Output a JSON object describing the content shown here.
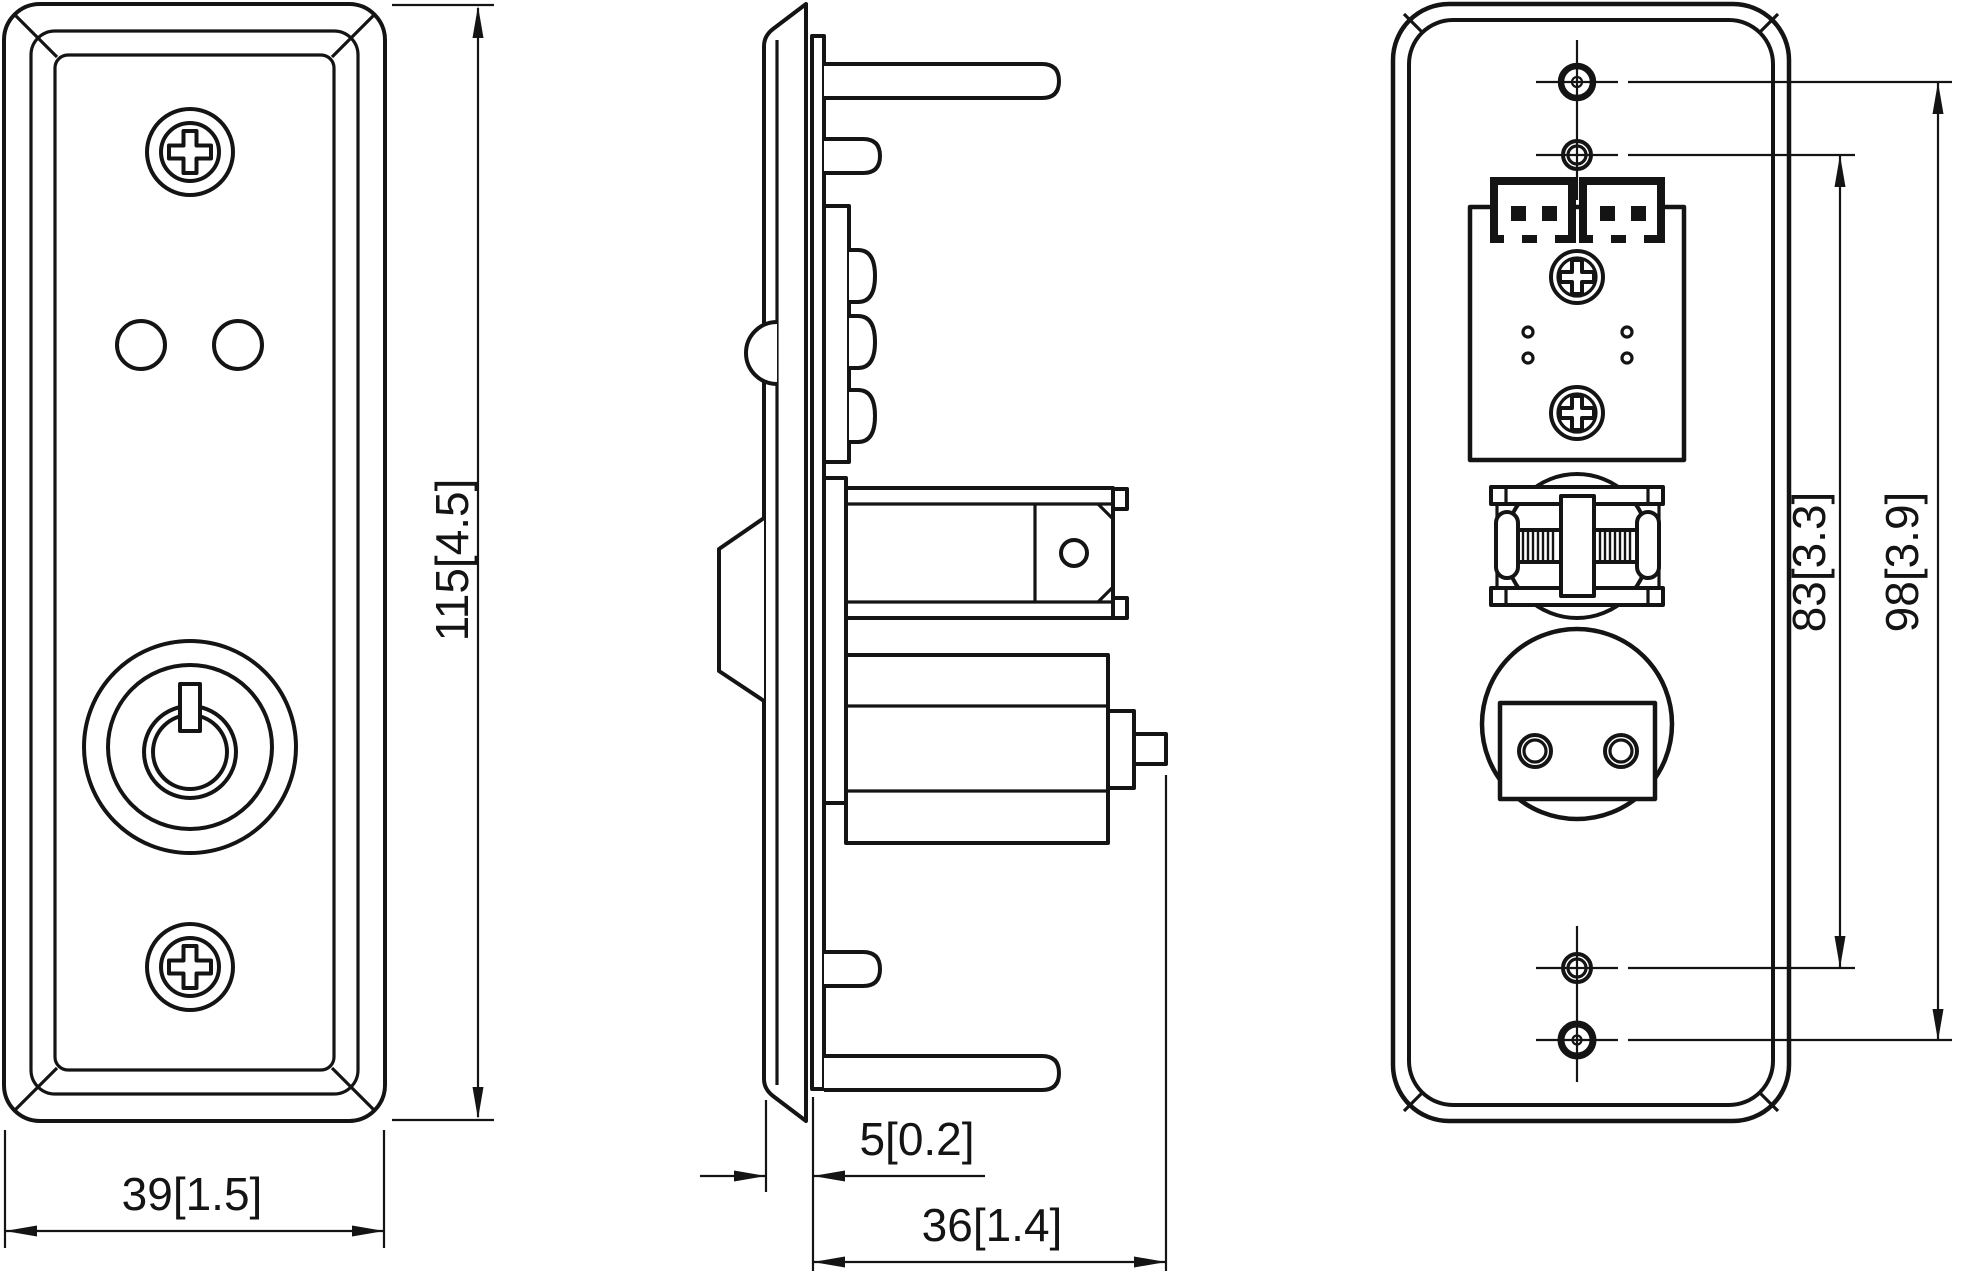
{
  "drawing": {
    "background": "#ffffff",
    "line_color": "#141414",
    "dimensions": {
      "front_height": "115[4.5]",
      "front_width": "39[1.5]",
      "plate_offset": "5[0.2]",
      "mount_depth": "36[1.4]",
      "hole_span_inner": "83[3.3]",
      "hole_span_outer": "98[3.9]"
    }
  }
}
